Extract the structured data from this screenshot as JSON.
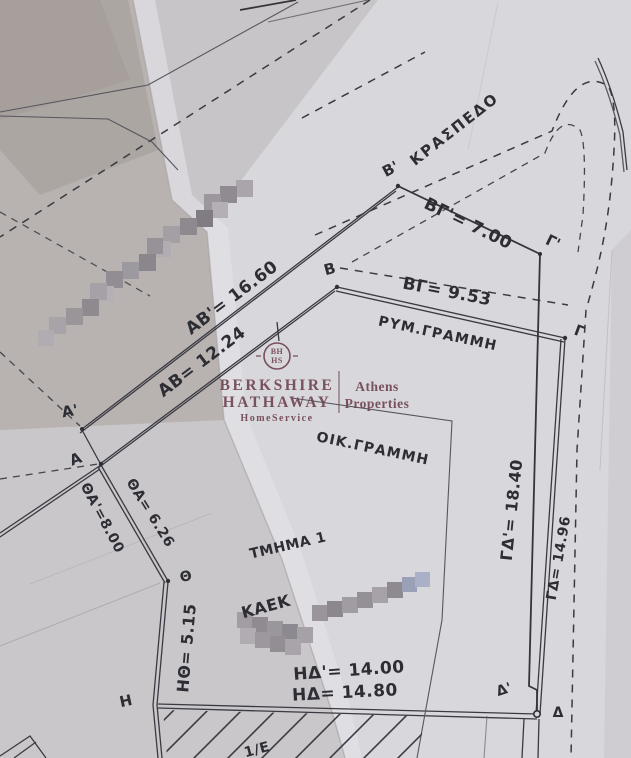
{
  "plan": {
    "street": {
      "kraspedo": "ΚΡΑΣΠΕΔΟ",
      "rym_grammi": "ΡΥΜ.ΓΡΑΜΜΗ",
      "oik_grammi": "ΟΙΚ.ΓΡΑΜΜΗ"
    },
    "section": {
      "tmima": "ΤΜΗΜΑ 1",
      "kaek_label": "ΚΑΕΚ",
      "fraction": "1/Ε"
    },
    "points": {
      "a_prime": "Α'",
      "a": "Α",
      "b_prime": "Β'",
      "b": "Β",
      "gamma_prime": "Γ'",
      "gamma": "Γ",
      "delta_prime": "Δ'",
      "delta": "Δ",
      "eta": "Η",
      "theta": "Θ"
    },
    "measurements": {
      "ab_prime": "ΑΒ'= 16.60",
      "ab": "ΑΒ= 12.24",
      "bg_prime": "ΒΓ'= 7.00",
      "bg": "ΒΓ= 9.53",
      "gd_prime": "ΓΔ'= 18.40",
      "gd": "ΓΔ= 14.96",
      "hd_prime": "ΗΔ'= 14.00",
      "hd": "ΗΔ= 14.80",
      "tha": "ΘΑ= 6.26",
      "tha_prime": "ΘΑ'=8.00",
      "hth": "ΗΘ= 5.15"
    }
  },
  "watermark": {
    "logo_top": "BH",
    "logo_bottom": "HS",
    "brand_line1": "BERKSHIRE",
    "brand_line2": "HATHAWAY",
    "brand_sub": "HomeService",
    "office_line1": "Athens",
    "office_line2": "Properties",
    "color": "#6e4350"
  },
  "colors": {
    "ink": "#2d2d34",
    "paper": "#d8d7db",
    "fold_dark": "#aba4a1"
  }
}
